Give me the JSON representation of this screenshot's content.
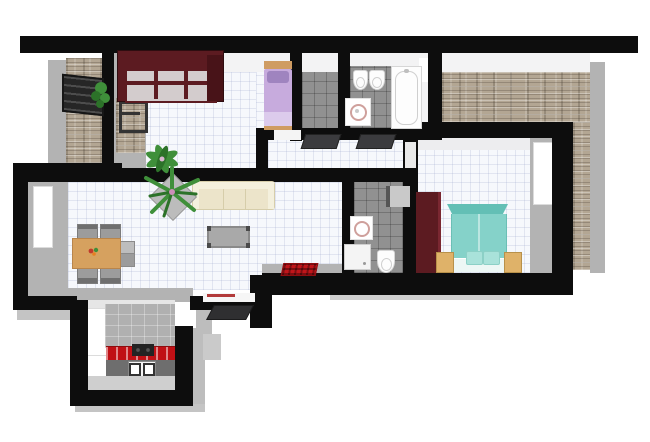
{
  "meta": {
    "description": "3D top-down architectural floor plan render of an apartment: living/dining room with sofa and dining set, kitchen nook with red countertop, two bedrooms (lavender single bed, teal double bed), two bathrooms, storage closet, hallway with doormats, stone balcony with pergola, and stone terrace.",
    "canvas": {
      "width": 650,
      "height": 442
    },
    "background": "#ffffff",
    "visible_text": "none"
  },
  "palette": {
    "wall": "#0d0d0d",
    "wall_face_gray": "#b3b3b3",
    "wall_face_gray_dark": "#9a9a9a",
    "wall_face_light": "#f3f3f4",
    "floor_tile": "#f6f8fc",
    "bath_tile": "#919191",
    "kitchen_wall_tile": "#b0b0b0",
    "kitchen_floor": "#cfcfcf",
    "stone_base": "#b3a693",
    "wardrobe": "#5c1b21",
    "wardrobe_side": "#481318",
    "wardrobe_interior": "#d3cccd",
    "bed_single_blanket": "#c7abdd",
    "bed_single_foot": "#dccbec",
    "bed_single_pillow": "#9f84bf",
    "bed_wood": "#cf9c62",
    "bed_double_head": "#63bfb5",
    "bed_double_body": "#85d2c9",
    "bed_double_pillow": "#a9e2da",
    "bed_double_sheet": "#edf7f5",
    "nightstand": "#dfb269",
    "sofa": "#ece4ca",
    "sofa_back": "#f4f0dd",
    "sofa_line": "#d6cdaa",
    "table_wood": "#d6a15f",
    "chair_gray": "#9c9c9c",
    "chair_top": "#bdbdbd",
    "coffee_table": "#a9a9a9",
    "counter_red": "#c01015",
    "cabinet_front": "#6e6e6e",
    "cooktop": "#232323",
    "oven_front": "#f5f5f5",
    "mat_dark": "#3b3b3e",
    "mat_red": "#c0151a",
    "plant_green": "#3f8f3a",
    "plant_green_dark": "#2c7229",
    "fixture_white": "#fdfdfd",
    "fixture_shadow": "#d6d6d6",
    "basin_rim": "#cfa09c",
    "pergola": "#262626",
    "threshold": "#f6f6f6"
  },
  "diagram": {
    "type": "floor-plan",
    "view": "top-down-3d-render",
    "rooms": [
      {
        "id": "balcony",
        "floor": "stone",
        "furniture": [
          "pergola-awning",
          "potted-plant"
        ]
      },
      {
        "id": "bedroom-small",
        "floor": "white-tile",
        "furniture": [
          "open-wardrobe-dark-red",
          "single-bed-lavender",
          "potted-plant",
          "window-to-balcony"
        ]
      },
      {
        "id": "storage-closet",
        "floor": "gray-tile",
        "furniture": []
      },
      {
        "id": "bathroom-main",
        "floor": "gray-tile",
        "furniture": [
          "bidet",
          "toilet",
          "washbasin-on-mat",
          "bathtub",
          "window"
        ]
      },
      {
        "id": "terrace",
        "floor": "stone",
        "furniture": []
      },
      {
        "id": "hallway",
        "floor": "white-tile",
        "furniture": [
          "doormat",
          "doormat"
        ]
      },
      {
        "id": "bathroom-ensuite",
        "floor": "gray-tile",
        "furniture": [
          "wall-cabinet",
          "washbasin-on-mat",
          "shower-tray",
          "toilet"
        ]
      },
      {
        "id": "bedroom-master",
        "floor": "white-tile",
        "furniture": [
          "wardrobe-dark-red",
          "double-bed-teal",
          "nightstand",
          "nightstand",
          "window"
        ]
      },
      {
        "id": "living-dining-room",
        "floor": "white-tile",
        "furniture": [
          "sofa-cream",
          "coffee-table",
          "dining-table-wood",
          "six-gray-chairs",
          "palm-plant-in-pot",
          "red-rug",
          "window"
        ]
      },
      {
        "id": "kitchen-nook",
        "floor": "gray",
        "furniture": [
          "red-countertop",
          "cooktop",
          "oven",
          "window"
        ]
      },
      {
        "id": "entrance",
        "floor": "none",
        "furniture": [
          "door-threshold",
          "dark-doormat"
        ]
      }
    ]
  }
}
